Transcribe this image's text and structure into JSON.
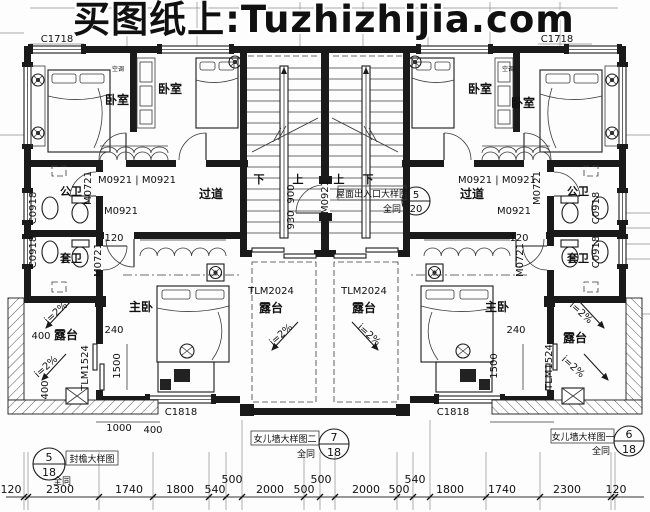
{
  "watermark": {
    "text": "买图纸上:Tuzhizhijia.com",
    "color": "#8e1414"
  },
  "rooms": {
    "bedroom": "卧室",
    "master_bedroom": "主卧",
    "public_bath": "公卫",
    "ensuite_bath": "套卫",
    "corridor": "过道",
    "terrace": "露台"
  },
  "openings": {
    "c1718": "C1718",
    "c0918": "C0918",
    "c1818": "C1818",
    "m0921": "M0921",
    "m0921_pair": "M0921 | M0921",
    "m0721": "M0721",
    "tlm2024": "TLM2024",
    "tlm1524": "TLM1524"
  },
  "stairs": {
    "up": "上",
    "down": "下"
  },
  "annotations": {
    "slope": "i=2%",
    "ac": "空调",
    "same": "全同"
  },
  "callouts": {
    "roof_access": {
      "label": "屋面出入口大样图",
      "num": "5",
      "den": "20"
    },
    "eave": {
      "label": "封檐大样图",
      "num": "5",
      "den": "18"
    },
    "parapet_two": {
      "label": "女儿墙大样图二",
      "num": "7",
      "den": "18"
    },
    "parapet_one": {
      "label": "女儿墙大样图一",
      "num": "6",
      "den": "18"
    }
  },
  "dims": {
    "d120": "120",
    "d240": "240",
    "d400": "400",
    "d900": "900",
    "d930": "930",
    "d1000": "1000",
    "d1500": "1500"
  },
  "bottom_dims": {
    "main": [
      "120",
      "2300",
      "1740",
      "1800",
      "540",
      "2000",
      "500",
      "2000",
      "500",
      "1800",
      "1740",
      "2300",
      "120"
    ],
    "raised": [
      "500",
      "500",
      "540"
    ]
  }
}
